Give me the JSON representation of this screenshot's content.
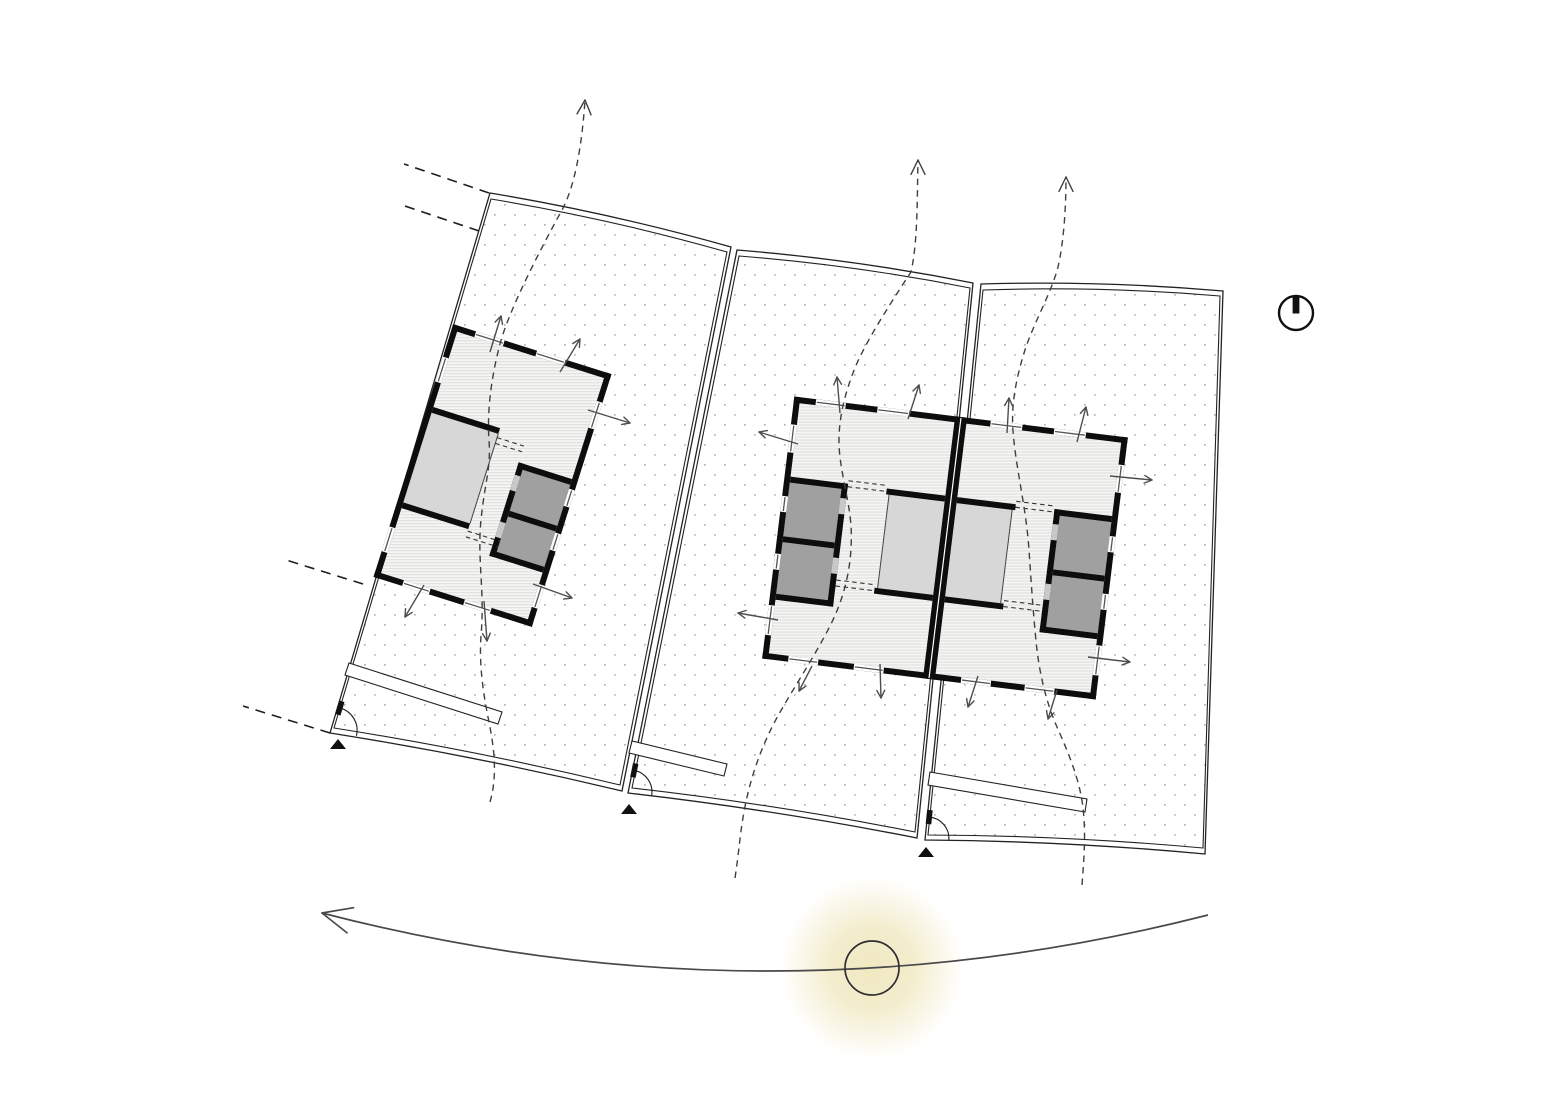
{
  "meta": {
    "title": "site-plan-ventilation-sun-diagram",
    "canvas": {
      "w": 1556,
      "h": 1100
    },
    "background": "#ffffff"
  },
  "colors": {
    "boundary": "#222222",
    "dots": "#b3b3b3",
    "wall": "#0d0d0d",
    "floor_base": "#f5f5f3",
    "floor_line": "#dbdbdb",
    "room_light": "#d7d7d7",
    "room_dark": "#a0a0a0",
    "door_patch": "#c8c8c8",
    "glass": "#555555",
    "arrow": "#4d4d4d",
    "flow": "#3f3f3f",
    "extension": "#1f1f1f",
    "driveway_fill": "#ffffff",
    "gate": "#1a1a1a",
    "marker": "#111111",
    "north": "#111111",
    "sun_stroke": "#2f2f2f",
    "sun_glow": "#f0e7bd",
    "sun_arc": "#4a4a4a"
  },
  "symbols": {
    "north_indicator": "north-indicator",
    "sun": "sun-position",
    "sun_path": "sun-path-arc",
    "flow_lines": "natural-ventilation-flow",
    "wall_arrows": "cross-ventilation-arrows",
    "entrance_markers": "plot-entrance-markers"
  },
  "plots": [
    {
      "name": "plot-1",
      "outer": [
        [
          490,
          193
        ],
        [
          731,
          247
        ],
        [
          622,
          791
        ],
        [
          330,
          733
        ]
      ],
      "inner": [
        [
          491,
          199
        ],
        [
          727,
          252
        ],
        [
          620,
          785
        ],
        [
          334,
          728
        ]
      ],
      "bow_top": 7,
      "bow_bottom": 6
    },
    {
      "name": "plot-2",
      "outer": [
        [
          737,
          250
        ],
        [
          973,
          283
        ],
        [
          917,
          838
        ],
        [
          628,
          793
        ]
      ],
      "inner": [
        [
          739,
          256
        ],
        [
          970,
          288
        ],
        [
          915,
          832
        ],
        [
          632,
          788
        ]
      ],
      "bow_top": 7,
      "bow_bottom": 6
    },
    {
      "name": "plot-3",
      "outer": [
        [
          981,
          284
        ],
        [
          1223,
          291
        ],
        [
          1205,
          854
        ],
        [
          925,
          840
        ]
      ],
      "inner": [
        [
          983,
          290
        ],
        [
          1220,
          296
        ],
        [
          1203,
          848
        ],
        [
          928,
          835
        ]
      ],
      "bow_top": 7,
      "bow_bottom": 6
    }
  ],
  "extension_lines": [
    [
      489,
      193,
      404,
      164
    ],
    [
      479,
      231,
      399,
      204
    ],
    [
      363,
      584,
      286,
      560
    ],
    [
      330,
      733,
      243,
      706
    ]
  ],
  "driveways": [
    [
      [
        349,
        663
      ],
      [
        502,
        712
      ],
      [
        498,
        724
      ],
      [
        345,
        675
      ]
    ],
    [
      [
        632,
        741
      ],
      [
        727,
        764
      ],
      [
        724,
        776
      ],
      [
        629,
        753
      ]
    ],
    [
      [
        930,
        772
      ],
      [
        1087,
        799
      ],
      [
        1085,
        812
      ],
      [
        928,
        785
      ]
    ]
  ],
  "gates": [
    {
      "d": "M 339.8 708 A 23 23 0 0 1 356.5 735.7",
      "post": [
        [
          344.5,
          702.1
        ],
        [
          339.1,
          700.5
        ],
        [
          335.1,
          713.9
        ],
        [
          340.5,
          715.5
        ]
      ]
    },
    {
      "d": "M 634.3 770.4 A 22 22 0 0 1 651.7 795.4",
      "post": [
        [
          638.4,
          764.1
        ],
        [
          633,
          763
        ],
        [
          630.2,
          776.8
        ],
        [
          635.6,
          777.9
        ]
      ]
    },
    {
      "d": "M 929.2 817.1 A 21.5 21.5 0 0 1 948.9 840.1",
      "post": [
        [
          932.7,
          810.4
        ],
        [
          927.1,
          809.8
        ],
        [
          925.7,
          823.8
        ],
        [
          931.3,
          824.4
        ]
      ]
    }
  ],
  "entrance_markers": [
    [
      [
        338,
        739
      ],
      [
        330,
        749
      ],
      [
        346,
        749
      ]
    ],
    [
      [
        629,
        804
      ],
      [
        621,
        814
      ],
      [
        637,
        814
      ]
    ],
    [
      [
        926,
        847
      ],
      [
        918,
        857
      ],
      [
        934,
        857
      ]
    ]
  ],
  "buildings": [
    {
      "name": "building-1",
      "cx": 492.5,
      "cy": 475.5,
      "w": 166,
      "h": 265,
      "rot": 17.5,
      "hatch": [
        [
          6,
          6,
          154,
          253
        ]
      ],
      "rooms_light": [
        [
          6,
          91,
          70,
          94
        ]
      ],
      "rooms_dark": [
        [
          110,
          118,
          50,
          43
        ],
        [
          110,
          167,
          50,
          37
        ]
      ],
      "walls": [
        [
          0,
          0,
          166,
          6
        ],
        [
          160,
          0,
          6,
          265
        ],
        [
          0,
          259,
          166,
          6
        ],
        [
          0,
          0,
          6,
          265
        ],
        [
          6,
          85,
          70,
          6
        ],
        [
          6,
          185,
          70,
          6
        ],
        [
          104,
          112,
          56,
          6
        ],
        [
          104,
          112,
          6,
          98
        ],
        [
          110,
          161,
          50,
          6
        ],
        [
          104,
          204,
          56,
          6
        ]
      ],
      "party_lines": [],
      "thin_lines": [
        [
          76,
          91,
          76,
          185
        ]
      ],
      "openings": [
        [
          76,
          95,
          104,
          95
        ],
        [
          76,
          101,
          104,
          101
        ],
        [
          76,
          193,
          110,
          193
        ],
        [
          76,
          199,
          110,
          199
        ]
      ],
      "doors": [
        [
          104,
          125,
          6,
          16
        ],
        [
          104,
          174,
          6,
          16
        ]
      ],
      "windows": [
        [
          24,
          0,
          30,
          6,
          "h"
        ],
        [
          88,
          0,
          30,
          6,
          "h"
        ],
        [
          160,
          30,
          6,
          28,
          "v"
        ],
        [
          160,
          122,
          6,
          18,
          "v"
        ],
        [
          160,
          168,
          6,
          18,
          "v"
        ],
        [
          160,
          222,
          6,
          24,
          "v"
        ],
        [
          30,
          259,
          28,
          6,
          "h"
        ],
        [
          94,
          259,
          28,
          6,
          "h"
        ],
        [
          0,
          34,
          6,
          26,
          "v"
        ],
        [
          0,
          212,
          6,
          26,
          "v"
        ]
      ]
    },
    {
      "name": "building-2-duplex",
      "cx": 945,
      "cy": 548,
      "w": 336,
      "h": 264,
      "rot": 7,
      "hatch": [
        [
          6,
          6,
          156,
          252
        ],
        [
          174,
          6,
          156,
          252
        ]
      ],
      "rooms_light": [
        [
          106,
          86,
          56,
          94
        ],
        [
          174,
          86,
          56,
          94
        ]
      ],
      "rooms_dark": [
        [
          6,
          86,
          52,
          54
        ],
        [
          6,
          146,
          52,
          52
        ],
        [
          278,
          86,
          52,
          54
        ],
        [
          278,
          146,
          52,
          52
        ]
      ],
      "walls": [
        [
          0,
          0,
          336,
          6
        ],
        [
          0,
          258,
          336,
          6
        ],
        [
          0,
          0,
          6,
          264
        ],
        [
          330,
          0,
          6,
          264
        ],
        [
          162,
          0,
          12,
          264
        ],
        [
          6,
          80,
          58,
          6
        ],
        [
          58,
          80,
          6,
          124
        ],
        [
          6,
          140,
          52,
          6
        ],
        [
          6,
          198,
          58,
          6
        ],
        [
          103,
          80,
          59,
          6
        ],
        [
          103,
          180,
          59,
          6
        ],
        [
          272,
          80,
          58,
          6
        ],
        [
          272,
          80,
          6,
          124
        ],
        [
          278,
          140,
          52,
          6
        ],
        [
          272,
          198,
          58,
          6
        ],
        [
          174,
          80,
          59,
          6
        ],
        [
          174,
          180,
          59,
          6
        ]
      ],
      "party_lines": [
        [
          168,
          1,
          168,
          263
        ]
      ],
      "thin_lines": [
        [
          106,
          86,
          106,
          180
        ],
        [
          230,
          86,
          230,
          180
        ]
      ],
      "openings": [
        [
          64,
          77,
          103,
          77
        ],
        [
          64,
          83,
          103,
          83
        ],
        [
          64,
          177,
          103,
          177
        ],
        [
          64,
          183,
          103,
          183
        ],
        [
          233,
          77,
          272,
          77
        ],
        [
          233,
          83,
          272,
          83
        ],
        [
          233,
          177,
          272,
          177
        ],
        [
          233,
          183,
          272,
          183
        ]
      ],
      "doors": [
        [
          58,
          95,
          6,
          16
        ],
        [
          58,
          155,
          6,
          16
        ],
        [
          272,
          95,
          6,
          16
        ],
        [
          272,
          155,
          6,
          16
        ]
      ],
      "windows": [
        [
          22,
          0,
          30,
          6,
          "h"
        ],
        [
          84,
          0,
          32,
          6,
          "h"
        ],
        [
          198,
          0,
          32,
          6,
          "h"
        ],
        [
          262,
          0,
          32,
          6,
          "h"
        ],
        [
          26,
          258,
          30,
          6,
          "h"
        ],
        [
          92,
          258,
          30,
          6,
          "h"
        ],
        [
          200,
          258,
          30,
          6,
          "h"
        ],
        [
          264,
          258,
          30,
          6,
          "h"
        ],
        [
          0,
          28,
          6,
          28,
          "v"
        ],
        [
          0,
          100,
          6,
          16,
          "v"
        ],
        [
          0,
          158,
          6,
          16,
          "v"
        ],
        [
          0,
          210,
          6,
          30,
          "v"
        ],
        [
          330,
          28,
          6,
          28,
          "v"
        ],
        [
          330,
          100,
          6,
          16,
          "v"
        ],
        [
          330,
          158,
          6,
          16,
          "v"
        ],
        [
          330,
          210,
          6,
          30,
          "v"
        ]
      ]
    }
  ],
  "flow_arrows": [
    {
      "d": "M 490 802 C 497 778 495 752 489 722 C 483 693 479 664 481 636 C 485 590 477 560 481 520 C 485 480 491 470 489 440 C 487 412 491 378 500 344 C 509 310 540 250 562 210 C 575 186 582 145 585 100",
      "tip": [
        585,
        100
      ],
      "from": [
        582,
        145
      ]
    },
    {
      "d": "M 735 878 C 739 852 740 833 744 812 C 750 778 762 744 779 714 C 796 684 816 654 831 624 C 846 594 853 560 851 526 C 849 496 838 466 839 436 C 840 414 845 394 853 373 C 862 348 886 310 911 272 C 918 240 917 200 918 160",
      "tip": [
        918,
        160
      ],
      "from": [
        918,
        205
      ]
    },
    {
      "d": "M 1082 885 C 1084 858 1086 834 1083 808 C 1080 780 1068 752 1057 727 C 1046 702 1039 672 1036 641 C 1033 610 1031 580 1029 550 C 1026 506 1016 470 1013 431 C 1011 405 1016 378 1025 350 C 1034 322 1051 294 1058 267 C 1064 241 1066 206 1066 177",
      "tip": [
        1066,
        177
      ],
      "from": [
        1066,
        222
      ]
    }
  ],
  "wall_arrows": [
    [
      490,
      352,
      501,
      316
    ],
    [
      560,
      372,
      580,
      339
    ],
    [
      588,
      410,
      630,
      423
    ],
    [
      424,
      585,
      405,
      617
    ],
    [
      484,
      601,
      487,
      641
    ],
    [
      533,
      584,
      572,
      598
    ],
    [
      840,
      413,
      837,
      377
    ],
    [
      908,
      419,
      919,
      385
    ],
    [
      1007,
      433,
      1009,
      398
    ],
    [
      1077,
      442,
      1086,
      407
    ],
    [
      798,
      444,
      759,
      432
    ],
    [
      778,
      620,
      738,
      613
    ],
    [
      1110,
      476,
      1152,
      480
    ],
    [
      1088,
      657,
      1130,
      662
    ],
    [
      812,
      666,
      799,
      691
    ],
    [
      880,
      664,
      881,
      698
    ],
    [
      978,
      676,
      968,
      707
    ],
    [
      1057,
      690,
      1048,
      719
    ]
  ],
  "north_symbol": {
    "cx": 1296,
    "cy": 313,
    "r": 17,
    "bar": [
      1292.6,
      296.5,
      6.8,
      17
    ]
  },
  "sun": {
    "cx": 872,
    "cy": 968,
    "r": 27,
    "glow_r": 92
  },
  "sun_path": {
    "d": "M 322 913 Q 765 1028 1208 915",
    "tip": [
      322,
      913
    ],
    "from": [
      400,
      933
    ]
  }
}
